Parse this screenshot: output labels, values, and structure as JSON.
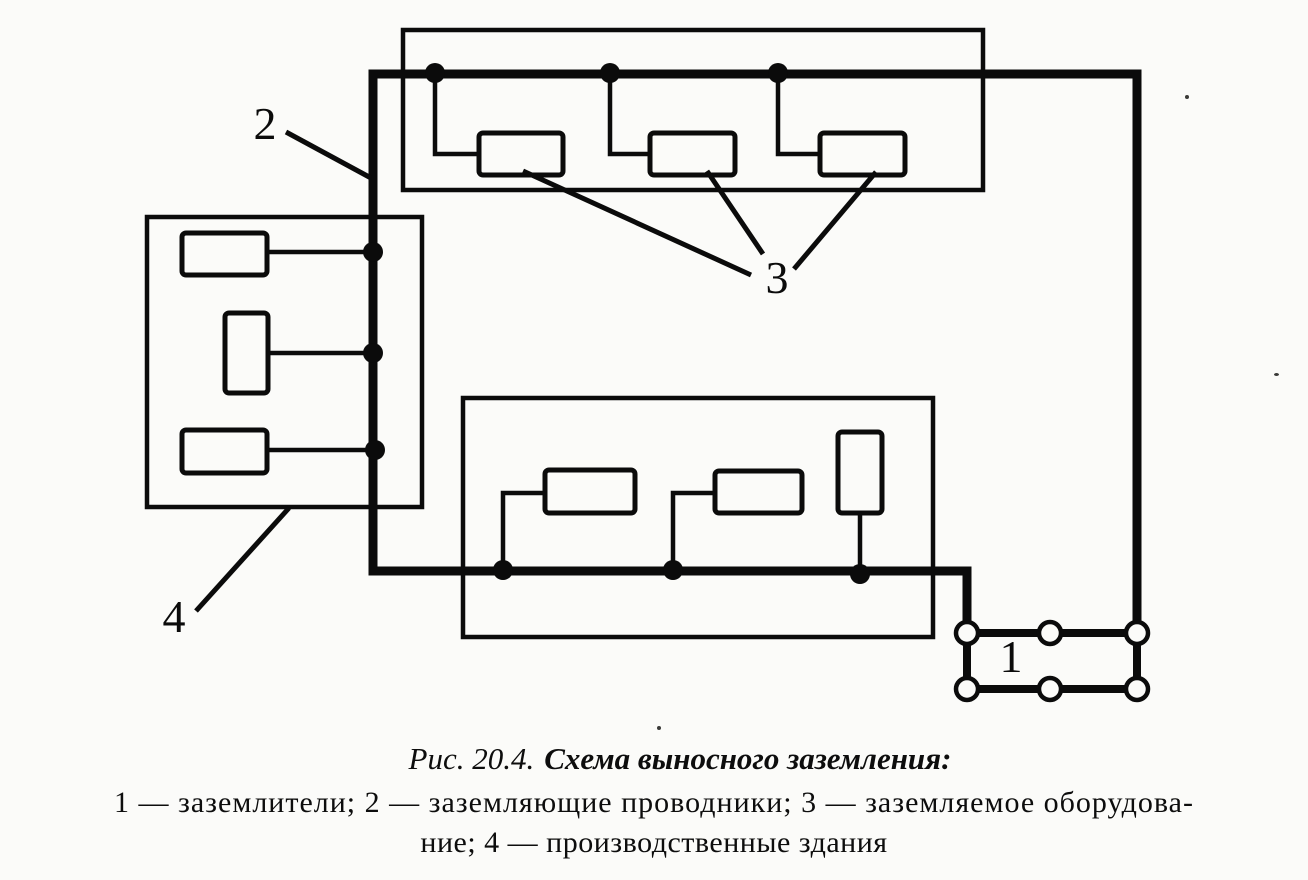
{
  "page": {
    "background_color": "#fbfbf9",
    "line_color": "#0b0b0b"
  },
  "figure": {
    "caption": {
      "prefix": "Рис. 20.4.",
      "title": "Схема выносного заземления:"
    },
    "legend": {
      "line1": "1 — заземлители; 2 — заземляющие проводники; 3 — заземляемое оборудова-",
      "line2": "ние; 4 — производственные здания"
    },
    "callouts": {
      "electrodes": "1",
      "conductors": "2",
      "equipment": "3",
      "buildings": "4"
    }
  }
}
